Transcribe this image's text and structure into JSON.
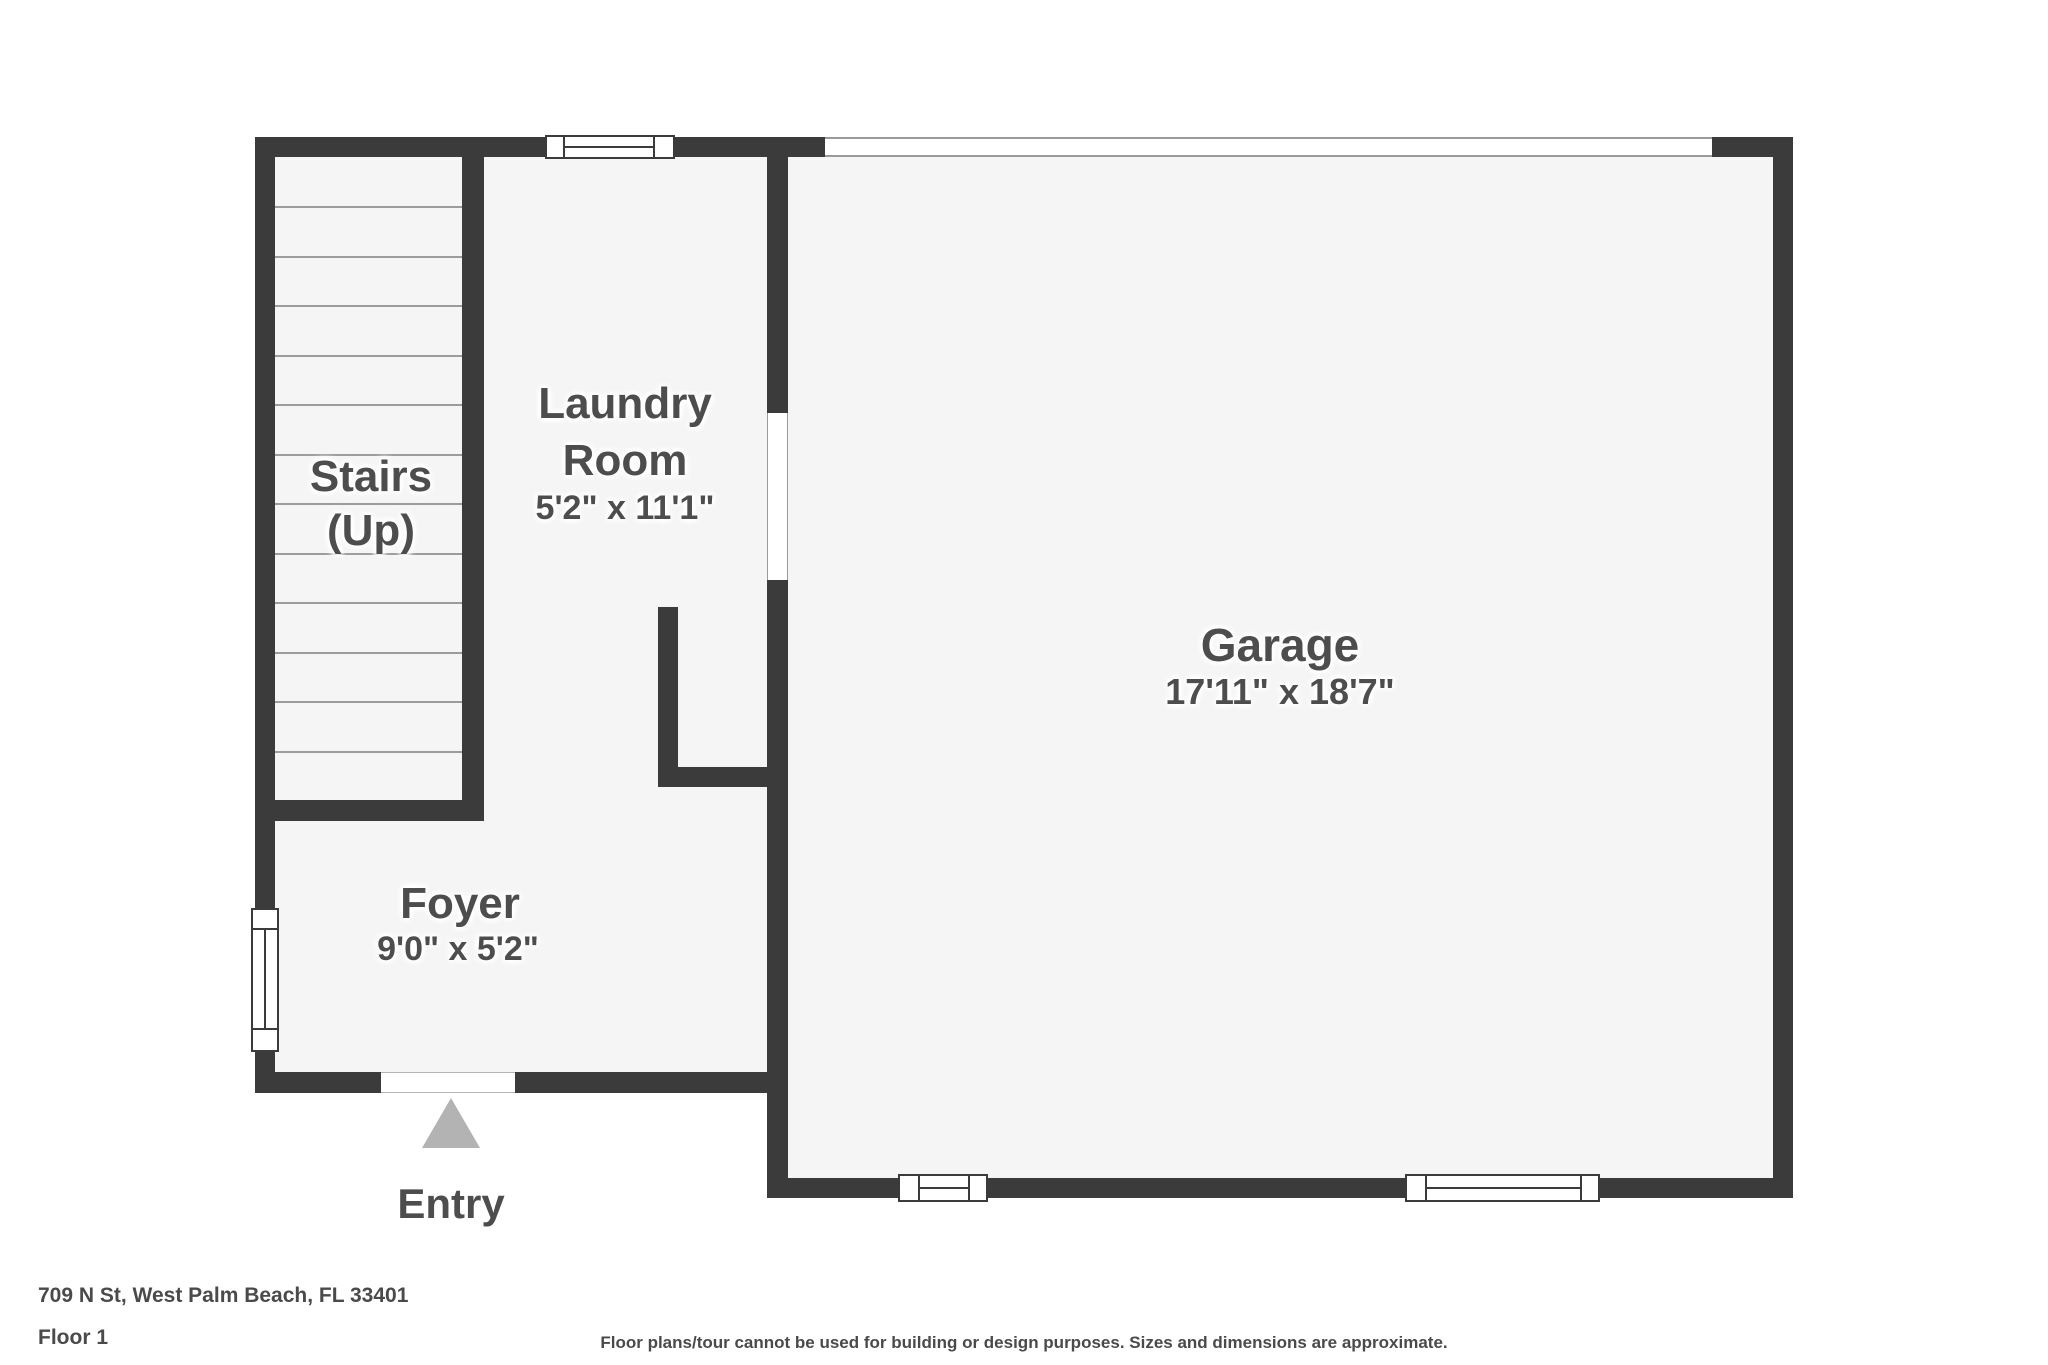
{
  "plan_title": "Floor plan",
  "rooms": {
    "stairs": {
      "line1": "Stairs",
      "line2": "(Up)"
    },
    "laundry": {
      "line1": "Laundry",
      "line2": "Room",
      "dims": "5'2\" x 11'1\""
    },
    "garage": {
      "name": "Garage",
      "dims": "17'11\" x 18'7\""
    },
    "foyer": {
      "name": "Foyer",
      "dims": "9'0\" x 5'2\""
    }
  },
  "entry": {
    "label": "Entry"
  },
  "footer": {
    "address": "709 N St, West Palm Beach, FL 33401",
    "floor": "Floor 1",
    "disclaimer": "Floor plans/tour cannot be used for building or design purposes. Sizes and dimensions are approximate."
  },
  "colors": {
    "wall": "#3b3b3c",
    "floor_fill": "#f5f5f6",
    "label_text": "#4d4d4d",
    "entry_arrow": "#b3b3b3",
    "tread_line": "#9c9c9c",
    "opening_line": "#9a9a9a"
  }
}
